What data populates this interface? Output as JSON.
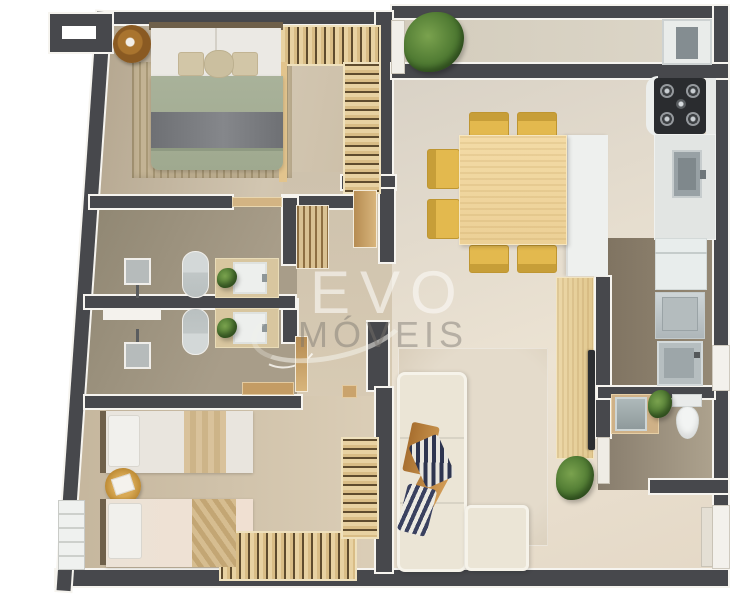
{
  "watermark": {
    "line1": "EVO",
    "line2": "MÓVEIS"
  },
  "palette": {
    "wall": "#47484c",
    "trim": "#f6f4ef",
    "floor-tan": "#cfc3ae",
    "floor-taupe": "#9d927e",
    "floor-light": "#e7decf",
    "floor-service": "#8d8170",
    "closet-wood": "#e8d2a2",
    "table-wood": "#f0d6a0",
    "chair-yellow": "#e3b94e",
    "sofa-cream": "#ebe5d6",
    "duvet-sage": "#a9b096",
    "blanket-gray": "#77797c",
    "steel-gray": "#98a1a5",
    "appliance-white": "#e8edec",
    "plant-green": "#4e7a33",
    "watermark-light": "rgba(250,249,245,0.62)",
    "watermark-gray": "rgba(120,116,108,0.45)"
  }
}
